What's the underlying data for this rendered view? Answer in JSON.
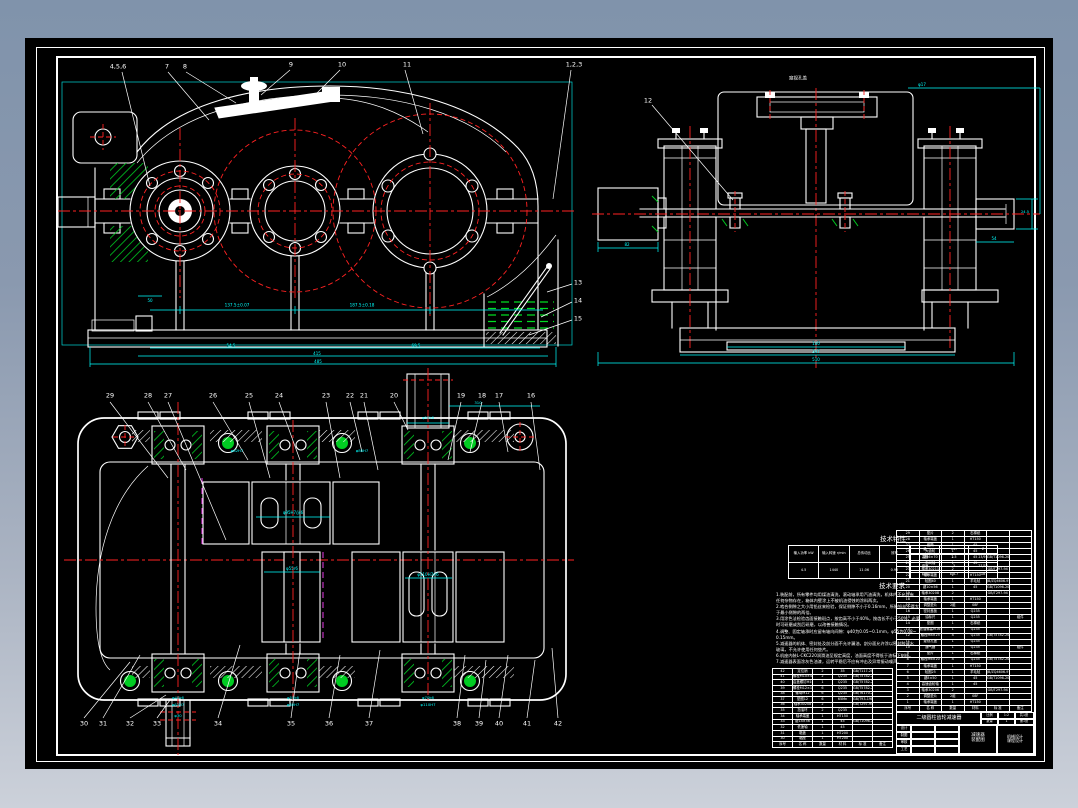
{
  "drawing": {
    "colors": {
      "background_top": "#8093ab",
      "background_bottom": "#ccd1da",
      "sheet": "#000000",
      "outline": "#ffffff",
      "centerline": "#ff2222",
      "dimension": "#00ffff",
      "hatch": "#00cc22",
      "phantom": "#ff44ff"
    },
    "views": [
      "front-view",
      "side-view",
      "top-section-view"
    ]
  },
  "labels": [
    {
      "name": "callout-4-5-6",
      "x": 118,
      "y": 67,
      "t": "4,5,6",
      "c": "w"
    },
    {
      "name": "callout-7",
      "x": 167,
      "y": 67,
      "t": "7",
      "c": "w"
    },
    {
      "name": "callout-8",
      "x": 185,
      "y": 67,
      "t": "8",
      "c": "w"
    },
    {
      "name": "callout-9",
      "x": 291,
      "y": 65,
      "t": "9",
      "c": "w"
    },
    {
      "name": "callout-10",
      "x": 342,
      "y": 65,
      "t": "10",
      "c": "w"
    },
    {
      "name": "callout-11",
      "x": 407,
      "y": 65,
      "t": "11",
      "c": "w"
    },
    {
      "name": "callout-1-2-3",
      "x": 574,
      "y": 65,
      "t": "1,2,3",
      "c": "w"
    },
    {
      "name": "callout-12",
      "x": 648,
      "y": 101,
      "t": "12",
      "c": "w"
    },
    {
      "name": "callout-13",
      "x": 578,
      "y": 283,
      "t": "13",
      "c": "w"
    },
    {
      "name": "callout-14",
      "x": 578,
      "y": 301,
      "t": "14",
      "c": "w"
    },
    {
      "name": "callout-15",
      "x": 578,
      "y": 319,
      "t": "15",
      "c": "w"
    },
    {
      "name": "callout-29",
      "x": 110,
      "y": 396,
      "t": "29",
      "c": "w"
    },
    {
      "name": "callout-28",
      "x": 148,
      "y": 396,
      "t": "28",
      "c": "w"
    },
    {
      "name": "callout-27",
      "x": 168,
      "y": 396,
      "t": "27",
      "c": "w"
    },
    {
      "name": "callout-26",
      "x": 213,
      "y": 396,
      "t": "26",
      "c": "w"
    },
    {
      "name": "callout-25",
      "x": 249,
      "y": 396,
      "t": "25",
      "c": "w"
    },
    {
      "name": "callout-24",
      "x": 279,
      "y": 396,
      "t": "24",
      "c": "w"
    },
    {
      "name": "callout-23",
      "x": 326,
      "y": 396,
      "t": "23",
      "c": "w"
    },
    {
      "name": "callout-22",
      "x": 350,
      "y": 396,
      "t": "22",
      "c": "w"
    },
    {
      "name": "callout-21",
      "x": 364,
      "y": 396,
      "t": "21",
      "c": "w"
    },
    {
      "name": "callout-20",
      "x": 394,
      "y": 396,
      "t": "20",
      "c": "w"
    },
    {
      "name": "callout-19",
      "x": 461,
      "y": 396,
      "t": "19",
      "c": "w"
    },
    {
      "name": "callout-18",
      "x": 482,
      "y": 396,
      "t": "18",
      "c": "w"
    },
    {
      "name": "callout-17",
      "x": 499,
      "y": 396,
      "t": "17",
      "c": "w"
    },
    {
      "name": "callout-16",
      "x": 531,
      "y": 396,
      "t": "16",
      "c": "w"
    },
    {
      "name": "callout-30",
      "x": 84,
      "y": 724,
      "t": "30",
      "c": "w"
    },
    {
      "name": "callout-31",
      "x": 103,
      "y": 724,
      "t": "31",
      "c": "w"
    },
    {
      "name": "callout-32",
      "x": 130,
      "y": 724,
      "t": "32",
      "c": "w"
    },
    {
      "name": "callout-33",
      "x": 157,
      "y": 724,
      "t": "33",
      "c": "w"
    },
    {
      "name": "callout-34",
      "x": 218,
      "y": 724,
      "t": "34",
      "c": "w"
    },
    {
      "name": "callout-35",
      "x": 291,
      "y": 724,
      "t": "35",
      "c": "w"
    },
    {
      "name": "callout-36",
      "x": 329,
      "y": 724,
      "t": "36",
      "c": "w"
    },
    {
      "name": "callout-37",
      "x": 369,
      "y": 724,
      "t": "37",
      "c": "w"
    },
    {
      "name": "callout-38",
      "x": 457,
      "y": 724,
      "t": "38",
      "c": "w"
    },
    {
      "name": "callout-39",
      "x": 479,
      "y": 724,
      "t": "39",
      "c": "w"
    },
    {
      "name": "callout-40",
      "x": 499,
      "y": 724,
      "t": "40",
      "c": "w"
    },
    {
      "name": "callout-41",
      "x": 527,
      "y": 724,
      "t": "41",
      "c": "w"
    },
    {
      "name": "callout-42",
      "x": 558,
      "y": 724,
      "t": "42",
      "c": "w"
    },
    {
      "name": "dim-center-distance-1",
      "x": 237,
      "y": 306,
      "t": "137.5±0.07",
      "c": "c",
      "fs": 4.2
    },
    {
      "name": "dim-center-distance-2",
      "x": 362,
      "y": 306,
      "t": "187.5±0.18",
      "c": "c",
      "fs": 4.2
    },
    {
      "name": "dim-50",
      "x": 150,
      "y": 301,
      "t": "50",
      "c": "c",
      "fs": 4
    },
    {
      "name": "dim-54-5",
      "x": 231,
      "y": 346,
      "t": "54.5",
      "c": "c",
      "fs": 4
    },
    {
      "name": "dim-69-5",
      "x": 416,
      "y": 346,
      "t": "69.5",
      "c": "c",
      "fs": 4
    },
    {
      "name": "dim-415",
      "x": 317,
      "y": 354,
      "t": "415",
      "c": "c",
      "fs": 4
    },
    {
      "name": "dim-485",
      "x": 318,
      "y": 362,
      "t": "485",
      "c": "c",
      "fs": 4
    },
    {
      "name": "side-view-note",
      "x": 798,
      "y": 80,
      "t": "窥视孔盖",
      "c": "w",
      "fs": 4.5
    },
    {
      "name": "dim-phi17",
      "x": 922,
      "y": 85,
      "t": "φ17",
      "c": "c",
      "fs": 4
    },
    {
      "name": "dim-82",
      "x": 627,
      "y": 245,
      "t": "82",
      "c": "c",
      "fs": 4
    },
    {
      "name": "dim-54",
      "x": 994,
      "y": 239,
      "t": "54",
      "c": "c",
      "fs": 4
    },
    {
      "name": "dim-24-5",
      "x": 1025,
      "y": 213,
      "t": "24.5",
      "c": "c",
      "fs": 3.6
    },
    {
      "name": "dim-180",
      "x": 816,
      "y": 344,
      "t": "180",
      "c": "c",
      "fs": 4
    },
    {
      "name": "dim-347",
      "x": 816,
      "y": 352,
      "t": "347",
      "c": "c",
      "fs": 4
    },
    {
      "name": "dim-510",
      "x": 816,
      "y": 360,
      "t": "510",
      "c": "c",
      "fs": 4
    },
    {
      "name": "dim-bore-upper",
      "x": 293,
      "y": 513,
      "t": "φ95H7/js6",
      "c": "c",
      "fs": 4
    },
    {
      "name": "dim-bore-pinion",
      "x": 292,
      "y": 569,
      "t": "φ55r6",
      "c": "c",
      "fs": 4
    },
    {
      "name": "dim-bore-gear",
      "x": 428,
      "y": 575,
      "t": "φ110H7/r6",
      "c": "c",
      "fs": 4
    },
    {
      "name": "dim-brg-1a",
      "x": 178,
      "y": 698,
      "t": "φ40k6",
      "c": "c",
      "fs": 3.8
    },
    {
      "name": "dim-brg-1b",
      "x": 178,
      "y": 705,
      "t": "φ62H7",
      "c": "c",
      "fs": 3.8
    },
    {
      "name": "dim-brg-2a",
      "x": 293,
      "y": 698,
      "t": "φ55k6",
      "c": "c",
      "fs": 3.8
    },
    {
      "name": "dim-brg-2b",
      "x": 293,
      "y": 705,
      "t": "φ80H7",
      "c": "c",
      "fs": 3.8
    },
    {
      "name": "dim-brg-3a",
      "x": 428,
      "y": 698,
      "t": "φ70k6",
      "c": "c",
      "fs": 3.8
    },
    {
      "name": "dim-brg-3b",
      "x": 428,
      "y": 705,
      "t": "φ110H7",
      "c": "c",
      "fs": 3.8
    },
    {
      "name": "dim-stub-top",
      "x": 428,
      "y": 418,
      "t": "φ55k6",
      "c": "c",
      "fs": 3.8
    },
    {
      "name": "dim-310",
      "x": 478,
      "y": 403,
      "t": "310",
      "c": "c",
      "fs": 3.8
    },
    {
      "name": "dim-stub-bottom",
      "x": 178,
      "y": 716,
      "t": "φ30",
      "c": "c",
      "fs": 3.8
    },
    {
      "name": "dim-wall-1",
      "x": 237,
      "y": 451,
      "t": "φ62H7",
      "c": "c",
      "fs": 3.8
    },
    {
      "name": "dim-wall-2",
      "x": 362,
      "y": 451,
      "t": "φ80H7",
      "c": "c",
      "fs": 3.8
    }
  ],
  "tech_table": {
    "title": "技术特性",
    "left_headers": [
      "输入功率 kW",
      "输入转速 r/min",
      "总传动比",
      "效率"
    ],
    "left_values": [
      "4.5",
      "1440",
      "11.06",
      "0.96"
    ],
    "right_rows": [
      [
        "级",
        "mn",
        "Z"
      ],
      [
        "高速",
        "2.5",
        "23/91"
      ],
      [
        "低速",
        "3",
        "27/76"
      ],
      [
        "精度",
        "8-8-7",
        "GB"
      ]
    ]
  },
  "tech_notes": {
    "title": "技术要求",
    "lines": [
      "1.装配前，所有零件均用煤油清洗，滚动轴承用汽油清洗，机体内不允许有",
      "  任何杂物存在，箱体内壁涂上不被机油侵蚀的涂料两次。",
      "2.啮合侧隙之大小用铅丝来检验，保证侧隙不小于0.16mm，所装铅丝不得大",
      "  于最小侧隙的两倍。",
      "3.用涂色法检验齿面接触斑点，按齿高不小于40%，按齿长不小于50%，必要",
      "  时可研磨或刮后研磨，以改善接触情况。",
      "4.调整、固定轴承时应留有轴向间隙：φ40为0.05~0.1mm，φ55为0.08~",
      "  0.15mm。",
      "5.减速器的机体、密封处及剖分面不允许漏油，剖分面允许涂以密封胶或水",
      "  玻璃，不允许使用任何垫片。",
      "6.机座内装L-CKC220润滑油至规定高度，油面高度不得低于油标下刻线。",
      "7.减速器表面涂灰色油漆，运转平稳后不应有冲击及异常振动噪声。"
    ]
  },
  "parts_left": {
    "headers": [
      "序号",
      "名 称",
      "数量",
      "材 料",
      "标 准",
      "备注"
    ],
    "rows": [
      [
        "42",
        "定位销",
        "2",
        "35",
        "GB/T117-2000",
        ""
      ],
      [
        "41",
        "螺栓M10×40",
        "2",
        "Q235",
        "GB/T5782-2000",
        ""
      ],
      [
        "40",
        "启盖螺钉M10×30",
        "1",
        "Q235",
        "GB/T5782-2000",
        ""
      ],
      [
        "39",
        "螺栓M12×120",
        "6",
        "Q235",
        "GB/T5782-2000",
        ""
      ],
      [
        "38",
        "螺母M12",
        "6",
        "Q235",
        "GB/T6170-2000",
        ""
      ],
      [
        "37",
        "垫圈12",
        "6",
        "65Mn",
        "GB/T93-1987",
        ""
      ],
      [
        "36",
        "轴承30208",
        "2",
        "",
        "GB/T297-94",
        ""
      ],
      [
        "35",
        "挡油环",
        "2",
        "Q235",
        "",
        ""
      ],
      [
        "34",
        "轴承端盖",
        "1",
        "HT150",
        "",
        ""
      ],
      [
        "33",
        "键14×56",
        "1",
        "45",
        "GB/T1096-2003",
        ""
      ],
      [
        "32",
        "低速轴",
        "1",
        "45",
        "",
        ""
      ],
      [
        "31",
        "箱盖",
        "1",
        "HT200",
        "",
        ""
      ],
      [
        "30",
        "箱座",
        "1",
        "HT200",
        "",
        ""
      ]
    ]
  },
  "parts_right": {
    "headers": [
      "序号",
      "名 称",
      "数量",
      "材料",
      "标 准",
      "备注"
    ],
    "rows": [
      [
        "29",
        "垫片",
        "2",
        "石棉纸",
        "",
        ""
      ],
      [
        "28",
        "轴承端盖",
        "1",
        "HT150",
        "",
        ""
      ],
      [
        "27",
        "套筒",
        "1",
        "45",
        "",
        ""
      ],
      [
        "26",
        "大齿轮",
        "1",
        "45",
        "",
        ""
      ],
      [
        "25",
        "键16×70",
        "1",
        "45",
        "GB/T1096-2003",
        ""
      ],
      [
        "24",
        "中间轴",
        "1",
        "45",
        "",
        ""
      ],
      [
        "23",
        "轴承30211",
        "2",
        "",
        "GB/T297-94",
        ""
      ],
      [
        "22",
        "轴承端盖",
        "1",
        "HT150",
        "",
        ""
      ],
      [
        "21",
        "毡圈40",
        "1",
        "羊毛毡",
        "JB/ZQ4606-97",
        ""
      ],
      [
        "20",
        "键10×56",
        "1",
        "45",
        "GB/T1096-2003",
        ""
      ],
      [
        "19",
        "轴承30208",
        "2",
        "",
        "GB/T297-94",
        ""
      ],
      [
        "18",
        "轴承端盖",
        "1",
        "HT150",
        "",
        ""
      ],
      [
        "17",
        "调整垫片",
        "2组",
        "08F",
        "",
        ""
      ],
      [
        "16",
        "密封盖板",
        "1",
        "Q235",
        "",
        ""
      ],
      [
        "15",
        "油标尺",
        "1",
        "Q235",
        "",
        "组件"
      ],
      [
        "14",
        "垫圈",
        "1",
        "石棉纸",
        "",
        ""
      ],
      [
        "13",
        "放油螺塞M16×1.5",
        "1",
        "Q235",
        "",
        ""
      ],
      [
        "12",
        "螺栓M8×25",
        "4",
        "Q235",
        "GB/T5782-2000",
        ""
      ],
      [
        "11",
        "窥视孔盖",
        "1",
        "Q235",
        "",
        ""
      ],
      [
        "10",
        "通气器",
        "1",
        "Q235",
        "",
        "组件"
      ],
      [
        "9",
        "垫片",
        "1",
        "石棉纸",
        "",
        ""
      ],
      [
        "8",
        "螺栓M6×20",
        "4",
        "Q235",
        "GB/T5782-2000",
        ""
      ],
      [
        "7",
        "轴承端盖",
        "1",
        "HT150",
        "",
        ""
      ],
      [
        "6",
        "毡圈25",
        "1",
        "羊毛毡",
        "JB/ZQ4606-97",
        ""
      ],
      [
        "5",
        "键8×50",
        "1",
        "45",
        "GB/T1096-2003",
        ""
      ],
      [
        "4",
        "高速齿轮轴",
        "1",
        "45",
        "",
        ""
      ],
      [
        "3",
        "轴承30206",
        "2",
        "",
        "GB/T297-94",
        ""
      ],
      [
        "2",
        "调整垫片",
        "2组",
        "08F",
        "",
        ""
      ],
      [
        "1",
        "轴承端盖",
        "1",
        "HT150",
        "",
        ""
      ]
    ]
  },
  "title_block": {
    "name": "二级圆柱齿轮减速器",
    "scale_label": "比例",
    "scale": "1:2",
    "qty_label": "数量",
    "qty": "1",
    "sheets_total": "共1张",
    "sheets_no": "第1张",
    "sign_rows": [
      "设计",
      "制图",
      "审核",
      "工艺"
    ],
    "doc_line1": "减速器",
    "doc_line2": "装配图",
    "org_line1": "机械设计",
    "org_line2": "课程设计"
  }
}
